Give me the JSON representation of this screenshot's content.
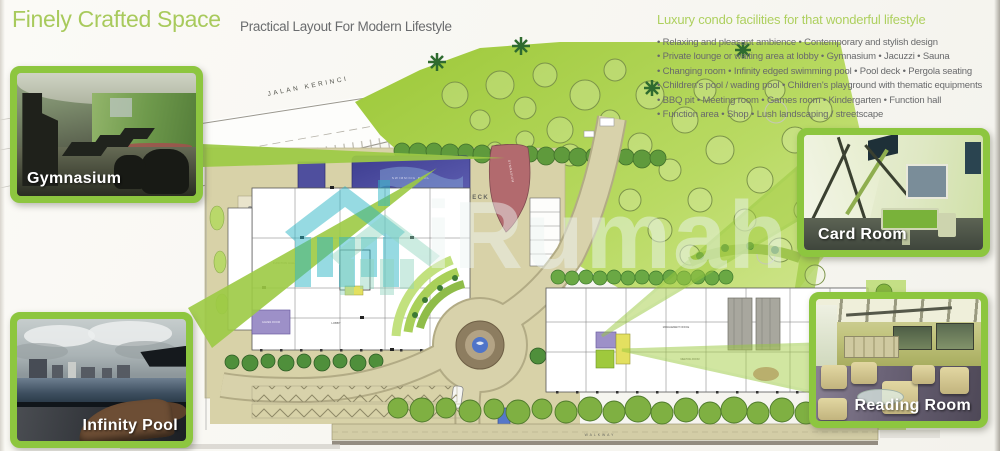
{
  "header": {
    "title": "Finely Crafted Space",
    "subtitle": "Practical Layout For Modern Lifestyle"
  },
  "facilities": {
    "heading": "Luxury condo facilities for that wonderful lifestyle",
    "lines": [
      "• Relaxing and pleasant ambience • Contemporary and stylish design",
      "• Private lounge or waiting area at lobby • Gymnasium • Jacuzzi • Sauna",
      "• Changing room • Infinity edged swimming pool • Pool deck • Pergola seating",
      "• Children's pool / wading pool • Children's playground with thematic equipments",
      "• BBQ pit • Meeting room • Games room • Kindergarten • Function hall",
      "• Function area • Shop • Lush landscaping / streetscape"
    ]
  },
  "insets": {
    "gymnasium": {
      "label": "Gymnasium"
    },
    "infinity_pool": {
      "label": "Infinity Pool"
    },
    "card_room": {
      "label": "Card Room"
    },
    "reading_room": {
      "label": "Reading Room"
    }
  },
  "plan": {
    "road_label": "JALAN KERINCI",
    "swimming_pool_label": "SWIMMING POOL",
    "pool_deck_label": "POOL DECK",
    "pool_deck_label_small": "POOL DECK",
    "playground_label": "PLAYGROUND",
    "gymnasium_label": "GYMNASIUM",
    "function_hall_label": "FUNCTION HALL",
    "lobby_label": "LOBBY",
    "games_room_label": "GAMES ROOM",
    "management_office_label": "MANAGEMENT OFFICE",
    "meeting_room_label": "MEETING ROOM",
    "walkway_label": "WALKWAY",
    "out_label": "OUT"
  },
  "watermark": {
    "text": "iRumah"
  },
  "colors": {
    "accent_green": "#8dc63f",
    "title_green": "#a8ca5c",
    "text_gray": "#6a6c6e",
    "pool_blue": "#4b4b9e",
    "plan_tan": "#d8d2a8",
    "landscape_green": "#a5ce4a",
    "watermark_teal": "#2fb6c6"
  }
}
